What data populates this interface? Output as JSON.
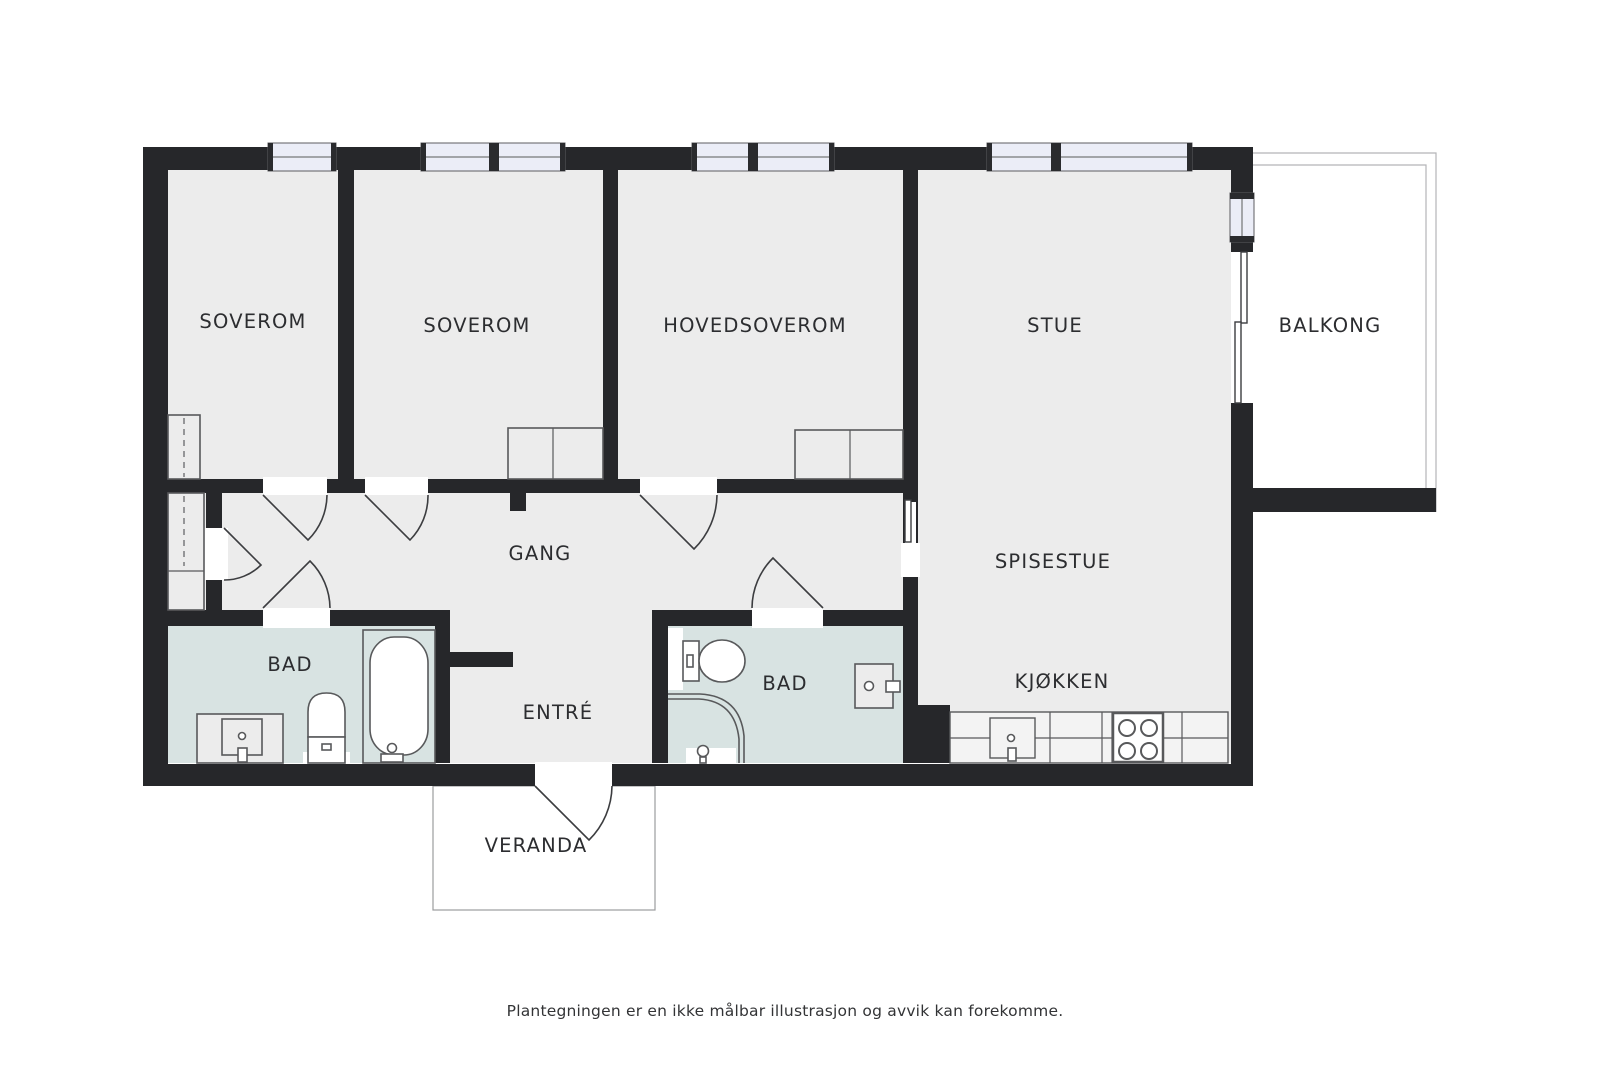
{
  "rooms": {
    "soverom1": "SOVEROM",
    "soverom2": "SOVEROM",
    "hovedsoverom": "HOVEDSOVEROM",
    "stue": "STUE",
    "balkong": "BALKONG",
    "gang": "GANG",
    "spisestue": "SPISESTUE",
    "kjokken": "KJØKKEN",
    "bad1": "BAD",
    "bad2": "BAD",
    "entre": "ENTRÉ",
    "veranda": "VERANDA"
  },
  "footer": {
    "disclaimer": "Plantegningen er en ikke målbar illustrasjon og avvik kan forekomme."
  },
  "colors": {
    "wall": "#26272a",
    "floor": "#ececec",
    "bathroom": "#d8e3e2",
    "window_glass": "#ebedf7",
    "fixture_outline": "#58595b"
  }
}
